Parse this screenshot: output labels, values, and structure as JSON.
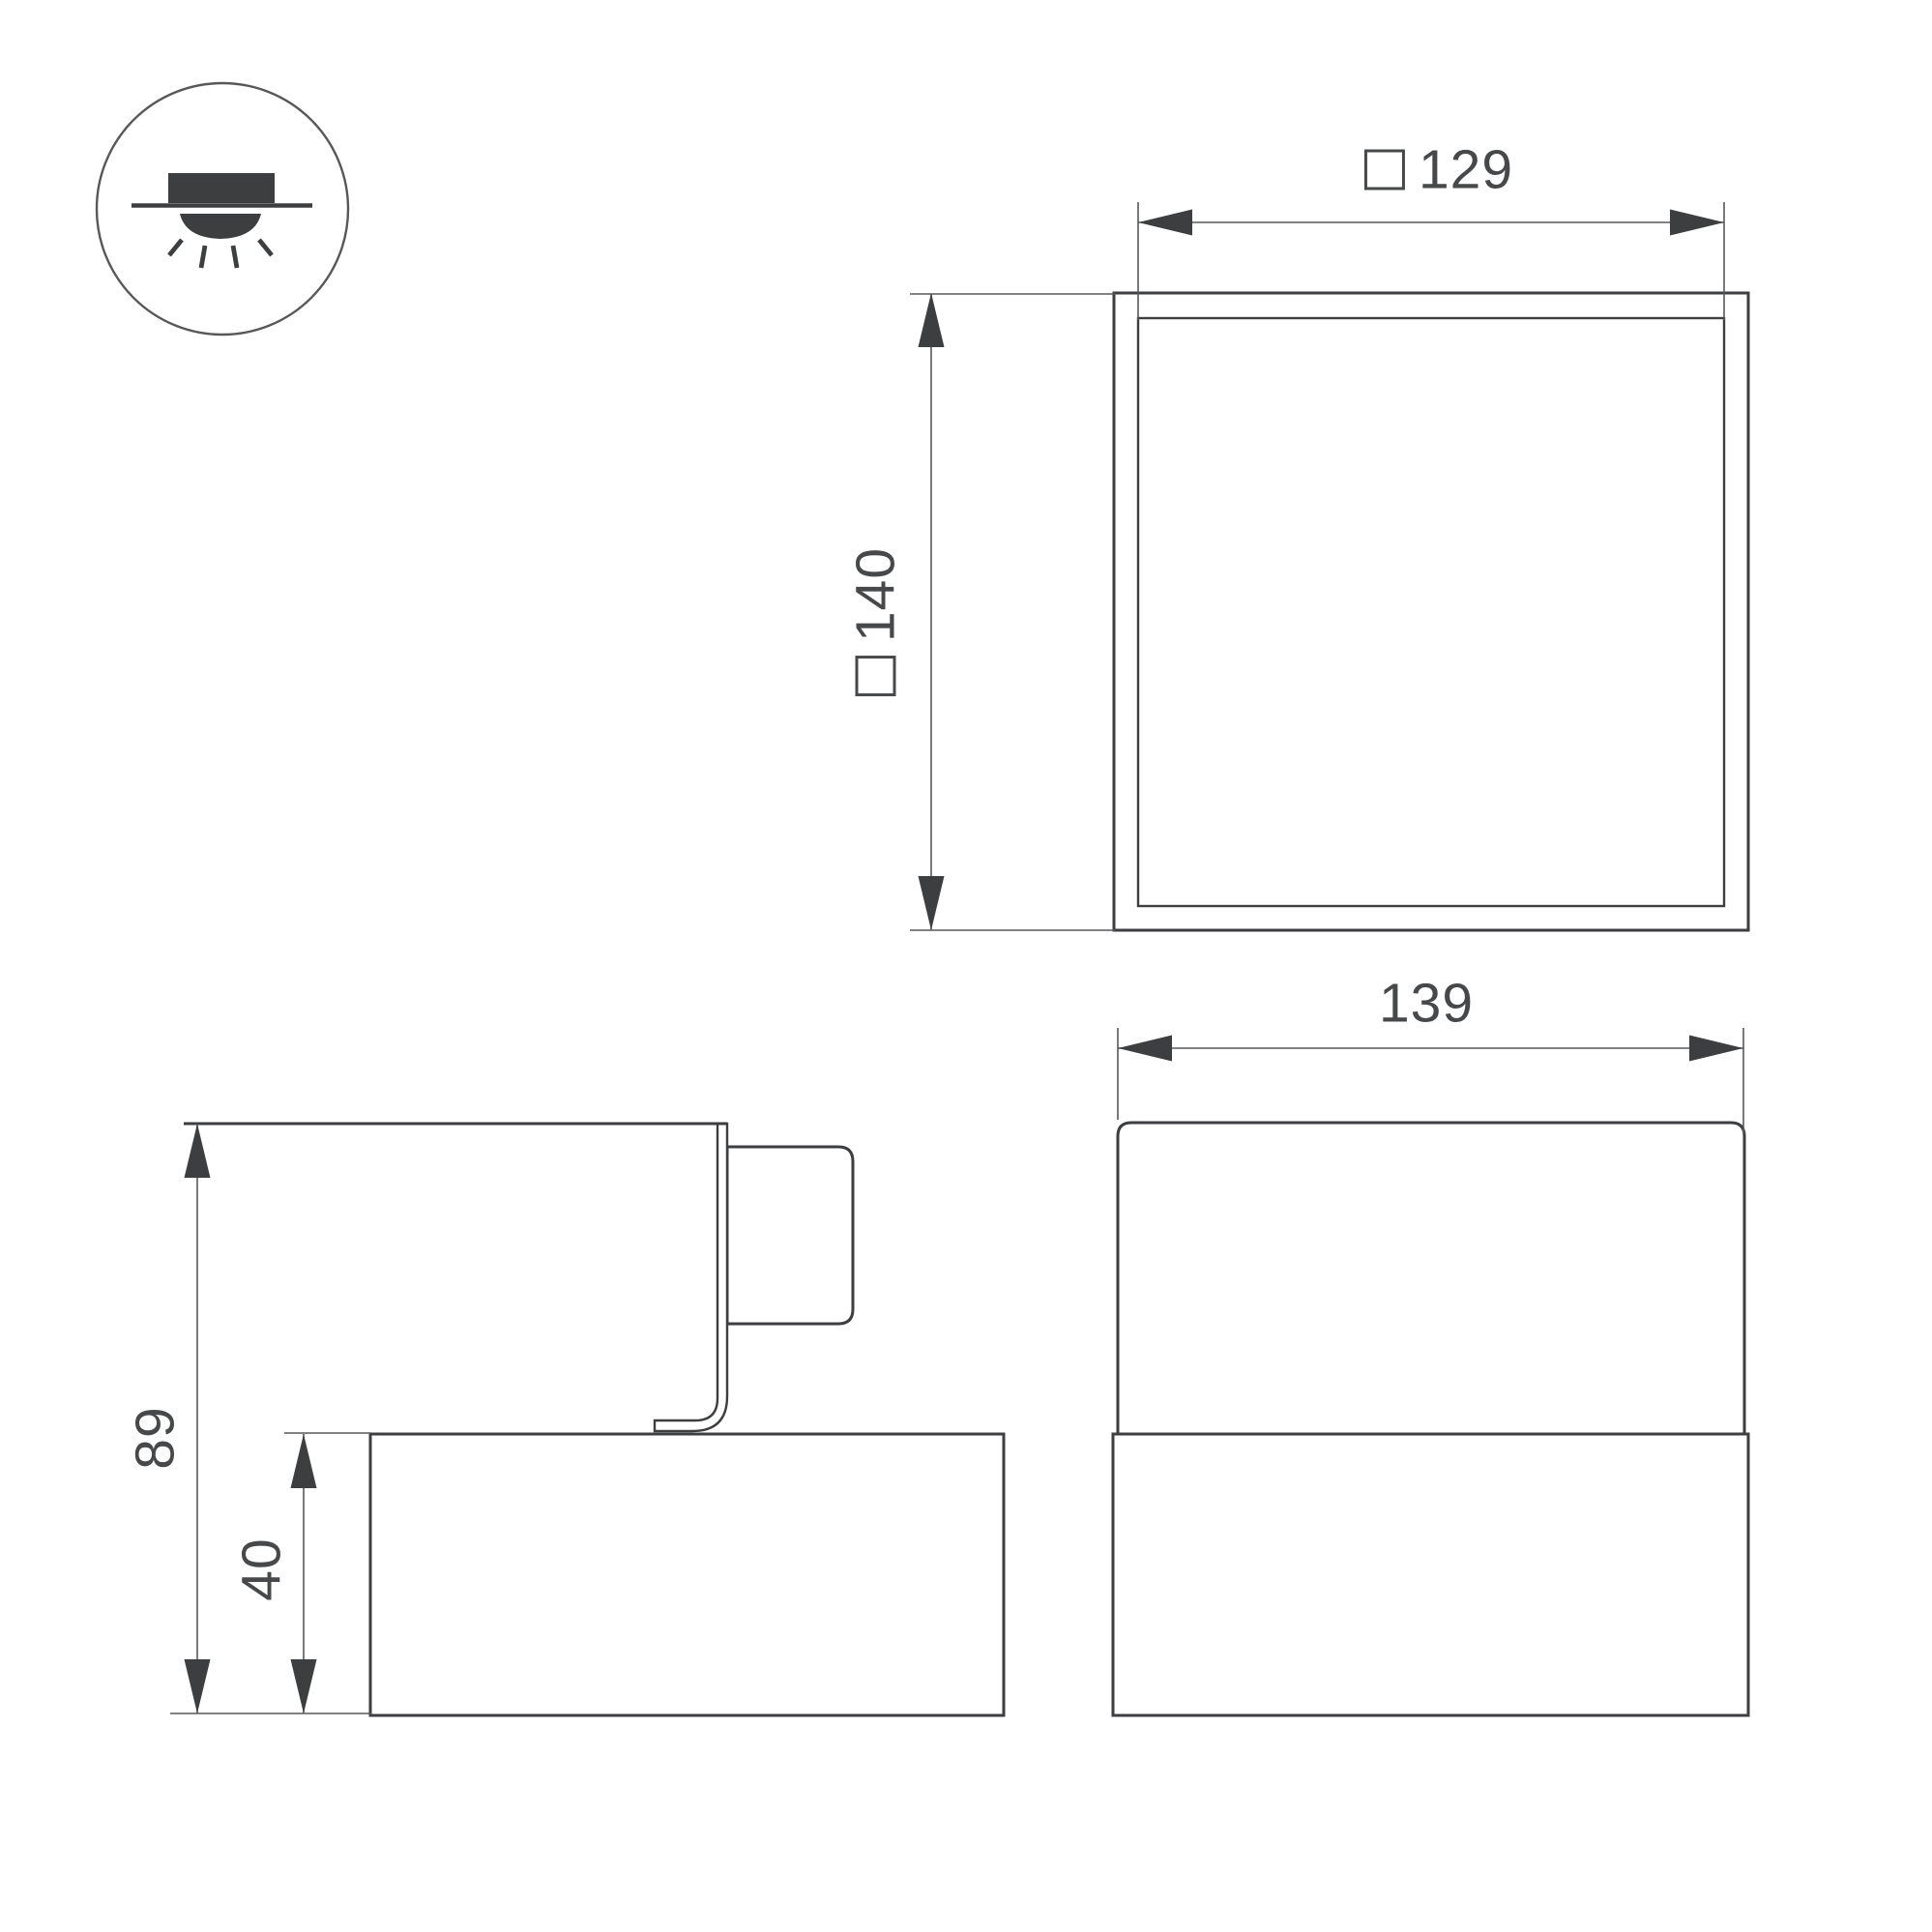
{
  "page": {
    "background": "#ffffff",
    "type": "luminaire-dimension-drawing"
  },
  "drawing": {
    "colors": {
      "outline": "#3d3e40",
      "dimension_line": "#58595b",
      "arrow_fill": "#3d3e40",
      "text": "#47484a",
      "icon_fill": "#3d3e40"
    },
    "icon": {
      "name": "surface-ceiling-downlight-symbol"
    },
    "top_view": {
      "width_dim": {
        "symbol": "□",
        "value": "129"
      },
      "height_dim": {
        "symbol": "□",
        "value": "140"
      }
    },
    "front_view": {
      "width_dim": {
        "value": "139"
      }
    },
    "side_view": {
      "total_height_dim": {
        "value": "89"
      },
      "base_height_dim": {
        "value": "40"
      }
    }
  }
}
